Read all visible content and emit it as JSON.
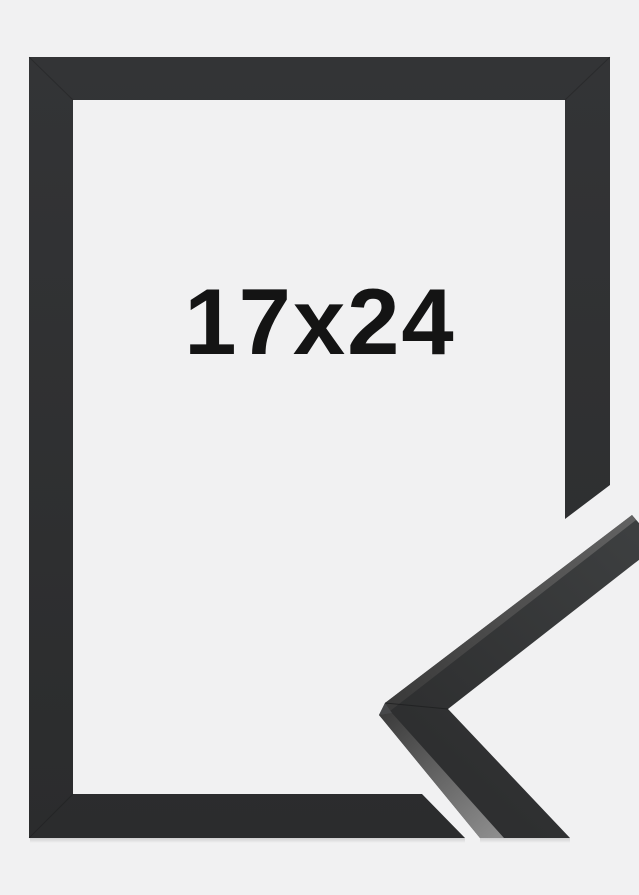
{
  "label": {
    "size": "17x24"
  },
  "colors": {
    "background": "#f1f1f2",
    "frame_top": "#333436",
    "frame_bottom": "#2b2c2d",
    "sample_face_light": "#3d3f40",
    "sample_face_dark": "#2e2f30",
    "strip_upper_light": "#626262",
    "strip_upper_dark": "#3a3a3a",
    "strip_lower_light": "#8d8d8d",
    "strip_lower_dark": "#3c3c3c",
    "tip_facet": "#47484a",
    "seam": "#1f2021",
    "text": "#141414"
  }
}
